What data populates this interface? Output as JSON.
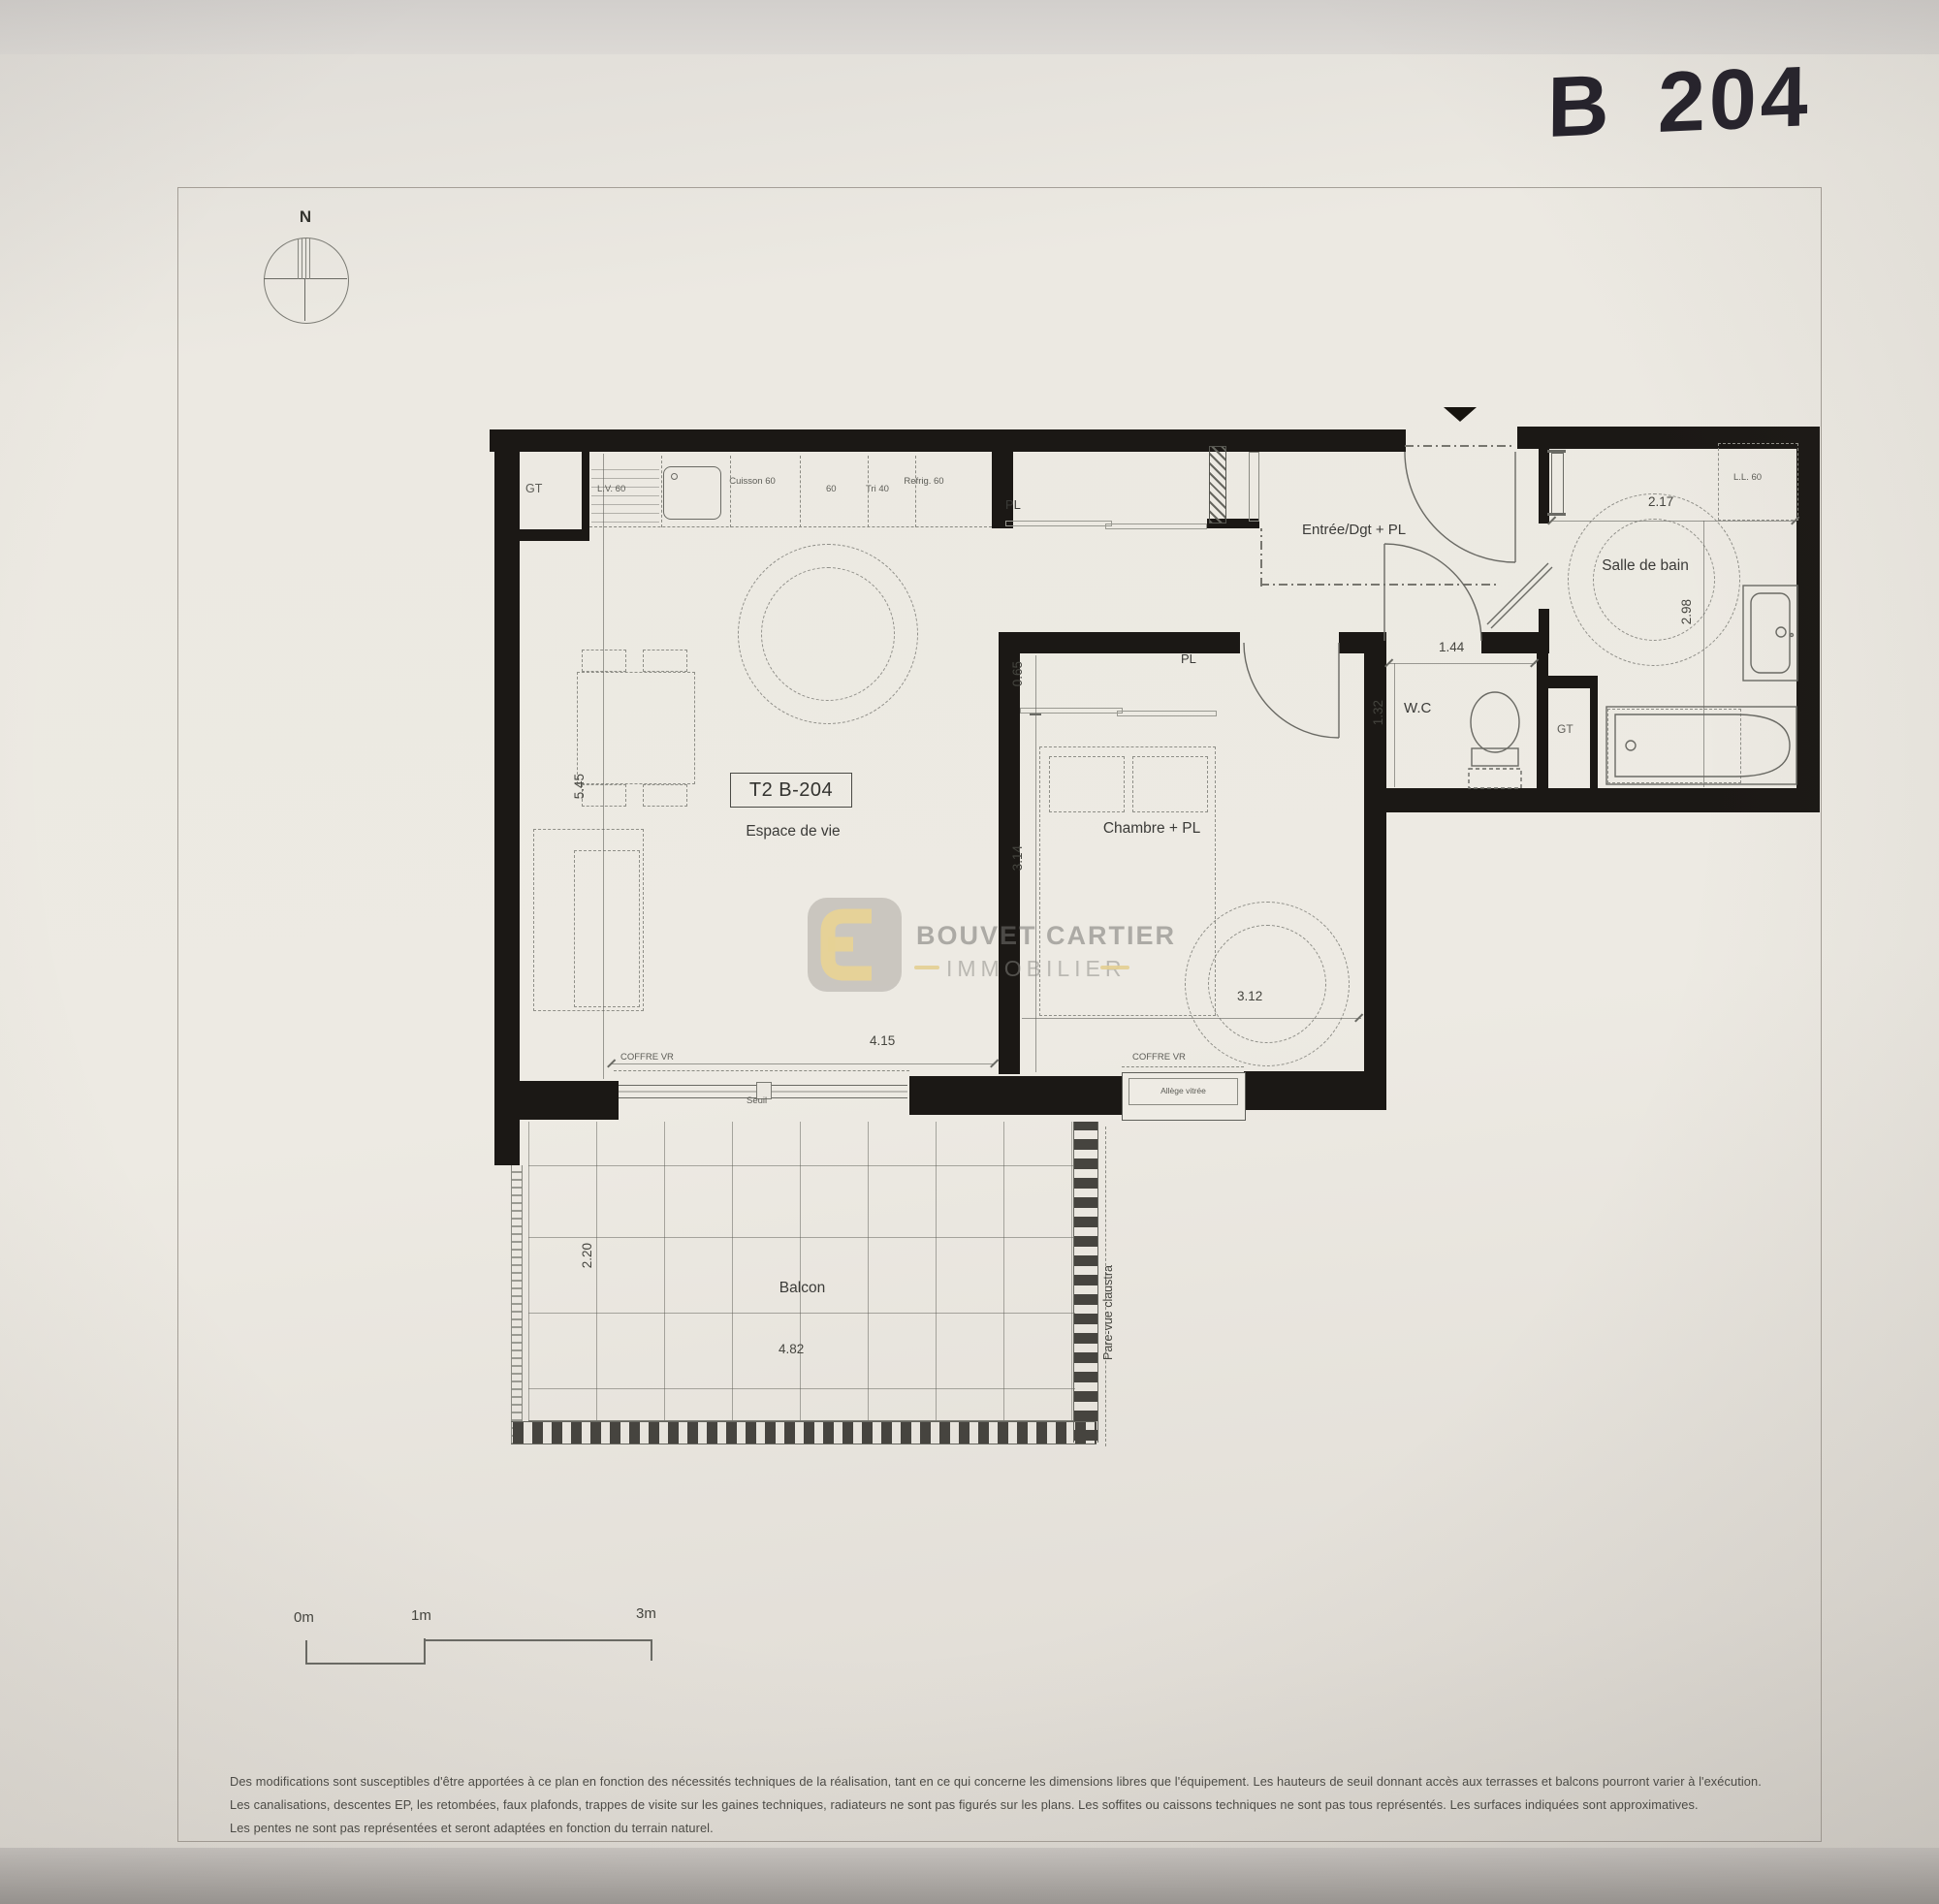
{
  "photo": {
    "handwritten_ref": "B 204"
  },
  "compass": {
    "north": "N"
  },
  "plan": {
    "unit_box": "T2 B-204",
    "rooms": {
      "living": "Espace de vie",
      "bedroom": "Chambre + PL",
      "entry": "Entrée/Dgt + PL",
      "bath": "Salle de bain",
      "wc": "W.C",
      "balcony": "Balcon"
    },
    "closets": {
      "entry_pl": "PL",
      "bedroom_pl": "PL"
    },
    "ducts": {
      "kitchen_gt": "GT",
      "wc_gt": "GT"
    },
    "kitchen": {
      "dishwasher": "L.V. 60",
      "hob": "Cuisson 60",
      "unit60": "60",
      "tri": "Tri 40",
      "fridge": "Refrig. 60"
    },
    "appliances": {
      "washer": "L.L. 60"
    },
    "dims": {
      "living_height": "5.45",
      "living_width": "4.15",
      "bedroom_closet": "0.65",
      "bedroom_height": "3.14",
      "bedroom_width": "3.12",
      "bath_width": "2.17",
      "bath_height": "2.98",
      "wc_width": "1.44",
      "wc_depth": "1.32",
      "balcony_depth": "2.20",
      "balcony_width": "4.82"
    },
    "openings": {
      "living_shutter": "COFFRE VR",
      "bedroom_shutter": "COFFRE VR",
      "threshold": "Seuil",
      "glazed_sill": "Allège vitrée",
      "privacy_screen": "Pare-vue claustra"
    }
  },
  "scale_bar": {
    "zero": "0m",
    "one": "1m",
    "three": "3m"
  },
  "watermark": {
    "name": "BOUVET CARTIER",
    "field": "IMMOBILIER"
  },
  "footnotes": {
    "line1": "Des modifications sont susceptibles d'être apportées à ce plan en fonction des nécessités techniques de la réalisation, tant en ce qui concerne les dimensions libres que l'équipement. Les hauteurs de seuil donnant accès aux terrasses et balcons pourront varier à l'exécution.",
    "line2": "Les canalisations, descentes EP, les retombées, faux plafonds, trappes de visite sur les gaines techniques, radiateurs ne sont pas figurés sur les plans. Les soffites ou caissons techniques ne sont pas tous représentés. Les surfaces indiquées sont approximatives.",
    "line3": "Les pentes ne sont pas représentées et seront adaptées en fonction du terrain naturel."
  },
  "colors": {
    "wall": "#1b1815",
    "paper": "#eae7e0",
    "gold": "#e2c065",
    "ink": "#25222b",
    "line": "#6a6a64"
  }
}
